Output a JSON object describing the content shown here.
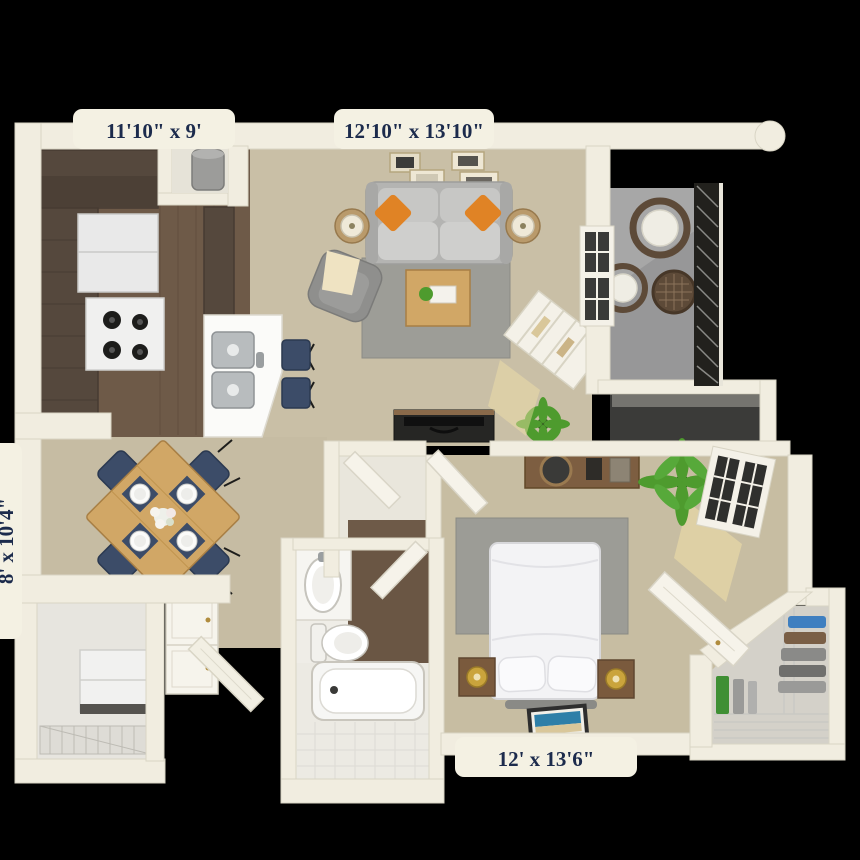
{
  "title": "apartment-floor-plan",
  "labels": {
    "kitchen": "11'10\" x 9'",
    "living_room": "12'10\" x 13'10\"",
    "dining": "8' x 10'4\"",
    "bedroom": "12' x 13'6\""
  },
  "palette": {
    "background": "#000000",
    "wall": "#f1ede0",
    "wall_edge": "#d9d5c5",
    "label_tab": "#f4f1e3",
    "label_text": "#1c2b4c",
    "wood_floor": "#6e5a48",
    "cabinet_brown": "#55483d",
    "carpet": "#c9bfa6",
    "balcony_concrete": "#a7a7a7",
    "railing_dark": "#22211d",
    "rug_gray": "#9d9d97",
    "sofa_gray": "#bebebc",
    "accent_orange": "#e08325",
    "dining_wood": "#d1a766",
    "chair_navy": "#3c4c68",
    "plant_green": "#4e9b2e",
    "nightstand_brown": "#7a5a3d",
    "artwork_teal": "#2e7fa8"
  },
  "rooms": [
    {
      "id": "kitchen",
      "dimensions": "11'10\" x 9'",
      "floor": "dark-wood",
      "furniture": [
        "upper-cabinets",
        "refrigerator",
        "range-4-burners",
        "double-basin-sink",
        "breakfast-bar",
        "water-heater-closet"
      ]
    },
    {
      "id": "living-room",
      "dimensions": "12'10\" x 13'10\"",
      "floor": "beige-carpet",
      "furniture": [
        "sofa",
        "orange-pillows",
        "side-table-lamps",
        "wall-frames",
        "area-rug",
        "coffee-table",
        "armchair-with-throw",
        "ladder-shelf",
        "tv-console",
        "floor-plant",
        "window",
        "bar-stools"
      ]
    },
    {
      "id": "balcony",
      "dimensions": null,
      "floor": "concrete",
      "furniture": [
        "wicker-chair",
        "wicker-chair",
        "wicker-table",
        "railing",
        "storage-closet"
      ]
    },
    {
      "id": "dining-area",
      "dimensions": "8' x 10'4\"",
      "floor": "beige-carpet",
      "furniture": [
        "square-table",
        "navy-chairs",
        "place-settings",
        "flower-centerpiece",
        "double-door-closet"
      ]
    },
    {
      "id": "laundry-room",
      "dimensions": null,
      "floor": "light",
      "furniture": [
        "washer",
        "dryer",
        "wire-shelf"
      ]
    },
    {
      "id": "entry",
      "dimensions": null,
      "floor": "beige-carpet",
      "furniture": [
        "front-door"
      ]
    },
    {
      "id": "bathroom",
      "dimensions": null,
      "floor": "wood-and-tile",
      "furniture": [
        "vanity-sink",
        "toilet",
        "bathtub",
        "door"
      ]
    },
    {
      "id": "bedroom",
      "dimensions": "12' x 13'6\"",
      "floor": "beige-carpet",
      "furniture": [
        "bed",
        "pillows",
        "nightstands",
        "gold-lamps",
        "area-rug",
        "dresser-with-mirror",
        "bench",
        "beach-artwork",
        "palm-plant",
        "windows",
        "doors"
      ]
    },
    {
      "id": "walk-in-closet",
      "dimensions": null,
      "floor": "light",
      "furniture": [
        "wire-shelving",
        "hanging-clothes",
        "blue-basket"
      ]
    }
  ]
}
